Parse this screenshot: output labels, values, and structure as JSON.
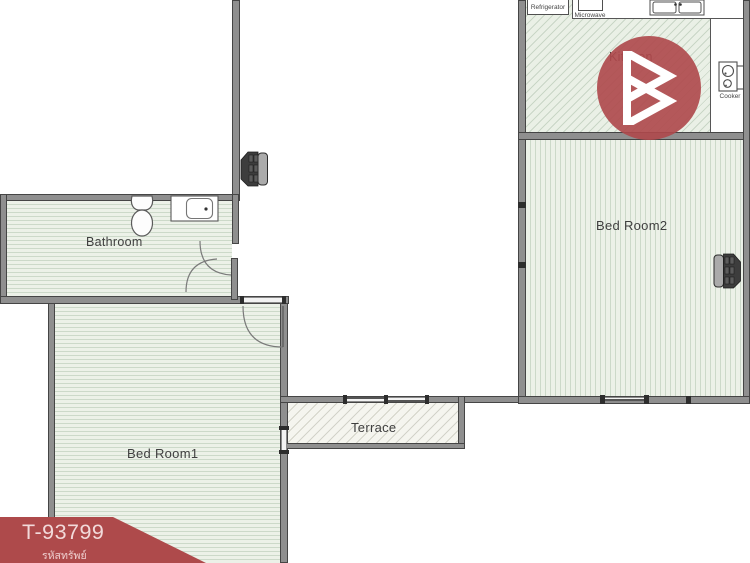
{
  "plan": {
    "rooms": {
      "bathroom": {
        "label": "Bathroom"
      },
      "bedroom1": {
        "label": "Bed Room1"
      },
      "bedroom2": {
        "label": "Bed Room2"
      },
      "kitchen": {
        "label": "Kitchen"
      },
      "terrace": {
        "label": "Terrace"
      }
    },
    "appliances": {
      "refrigerator": {
        "label": "Refrigerator"
      },
      "microwave": {
        "label": "Microwave"
      },
      "cooker": {
        "label": "Cooker"
      }
    }
  },
  "watermark": {
    "listing_code": "T-93799",
    "listing_code_caption": "รหัสทรัพย์"
  },
  "colors": {
    "brand_red": "#ae4a4b",
    "floor_tint_green": "#ecf1e8",
    "terrace_tint": "#f5f5ef",
    "wall_gray": "#8f8f8f",
    "label_text": "#3f3f3f"
  }
}
